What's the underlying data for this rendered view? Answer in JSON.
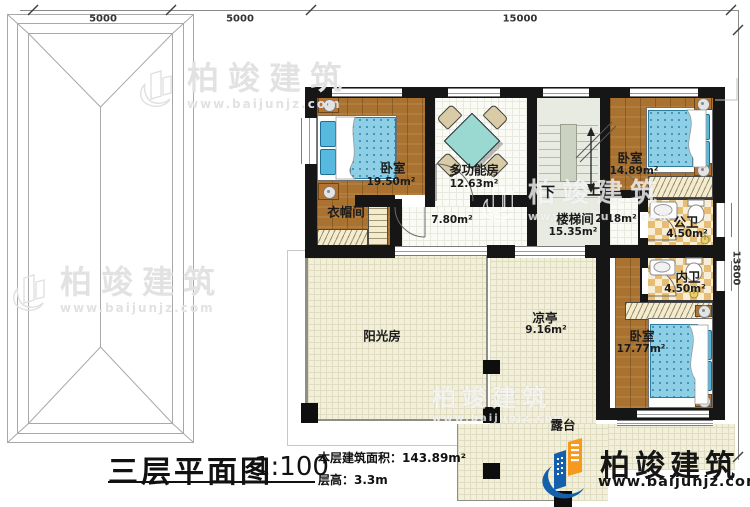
{
  "dims": {
    "d1": "5000",
    "d2": "5000",
    "d3": "15000",
    "d4": "13800"
  },
  "rooms": {
    "bedroom1": {
      "name": "卧室",
      "area": "19.50m²"
    },
    "multi": {
      "name": "多功能房",
      "area": "12.63m²"
    },
    "bedroom2": {
      "name": "卧室",
      "area": "14.89m²"
    },
    "cloak": {
      "name": "衣帽间"
    },
    "hall": {
      "area": "7.80m²"
    },
    "stair": {
      "name": "楼梯间",
      "area": "15.35m²",
      "down": "下",
      "up": "上"
    },
    "hall2": {
      "area": "2.18m²"
    },
    "pubbath": {
      "name": "公卫",
      "area": "4.50m²"
    },
    "pribath": {
      "name": "内卫",
      "area": "4.50m²"
    },
    "sunroom": {
      "name": "阳光房"
    },
    "pavilion": {
      "name": "凉亭",
      "area": "9.16m²"
    },
    "bedroom3": {
      "name": "卧室",
      "area": "17.77m²"
    },
    "terrace": {
      "name": "露台"
    }
  },
  "titleblock": {
    "title": "三层平面图",
    "scale": "1:100",
    "area_line": "本层建筑面积：143.89m²",
    "height_line": "层高：3.3m"
  },
  "brand": {
    "name": "柏竣建筑",
    "url": "www.baijunjz.com"
  },
  "watermark": {
    "name": "柏竣建筑",
    "url": "www.baijunjz.com"
  },
  "colors": {
    "wall": "#161616",
    "wood": "#a97231",
    "mattress": "#8ecfe6",
    "tile": "#e7bd74",
    "cream": "#f2efda",
    "stair_floor": "#e8ebe2",
    "brand_blue": "#1460ad",
    "brand_orange": "#f59a1d"
  }
}
